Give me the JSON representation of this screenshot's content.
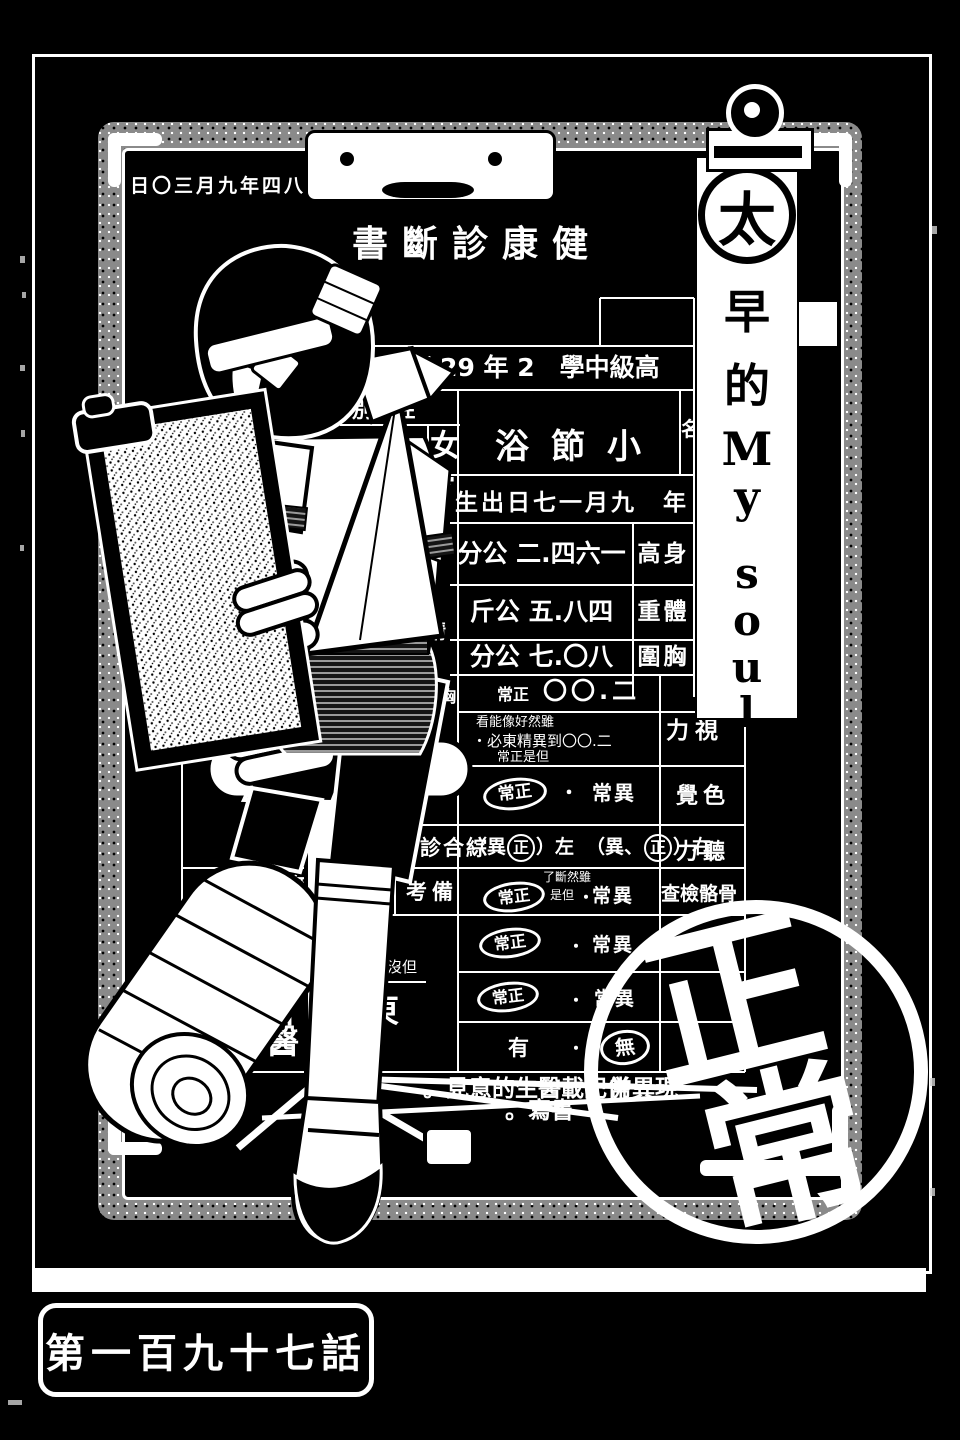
{
  "page": {
    "chapter_label": "第一百九十七話"
  },
  "banner": {
    "circled_char": "太",
    "chars": [
      "早",
      "的",
      "M",
      "y",
      "s",
      "o",
      "u",
      "l"
    ]
  },
  "form": {
    "date": "日〇三月九年四八和昭",
    "title": "書斷診康健",
    "school_row": "班 29 年 2　學中級高",
    "sex_header": "別 性",
    "name_header": "名",
    "sex_value": "女",
    "name_value": "浴節小",
    "ref_mark": "※",
    "birth_row": "生出日七一月九　年",
    "left_partial_header": "心中佳",
    "height": {
      "value": "分公 二.四六一",
      "label": "高身"
    },
    "weight": {
      "value": "斤公 五.八四",
      "label": "重體"
    },
    "chest": {
      "value": "分公 七.〇八",
      "label": "圍胸"
    },
    "vision": {
      "normal": "常正",
      "value": "〇〇.二",
      "label": "力視",
      "note1": "看能像好然雖",
      "note2": "・必東精異到〇〇.二",
      "note3": "常正是但"
    },
    "color": {
      "normal": "常正",
      "sep": "・",
      "abnormal": "常異",
      "label": "覺色"
    },
    "hearing": {
      "group_label": "斷診合綜",
      "seg1": "（異",
      "circ1": "正",
      "seg2": "）左",
      "seg3": "（異、",
      "circ2": "正",
      "seg4": "）右",
      "label": "力聽"
    },
    "bone": {
      "group_label": "考備",
      "normal": "常正",
      "note1": "了斷然雖",
      "note2": "是但",
      "sep": "・",
      "abnormal": "常異",
      "label": "查檢骼骨"
    },
    "row8": {
      "normal": "常正",
      "sep": "・",
      "abnormal": "常異"
    },
    "row9": {
      "normal": "常正",
      "sep": "・",
      "abnormal": "常異"
    },
    "row10": {
      "yes": "有",
      "sep": "・",
      "no": "無"
    },
    "left_group": {
      "mental_label": "神精",
      "normal1": "常正",
      "dot1": "・",
      "normal2": "常正",
      "dot2": "・",
      "xray_label": "胸部X光檢查",
      "normal3": "常正",
      "none_value": "無",
      "hand_fragment": "、處",
      "hand_note": "有沒但"
    },
    "hospital": {
      "line1_a": "川石",
      "line1_b": "東",
      "line2": "院醫"
    },
    "footnote": {
      "line1a": "。見意的生醫載記併一",
      "line1b": "、常異現",
      "line2": "。寫書"
    },
    "stamp": {
      "char1": "正",
      "char2": "常"
    }
  }
}
